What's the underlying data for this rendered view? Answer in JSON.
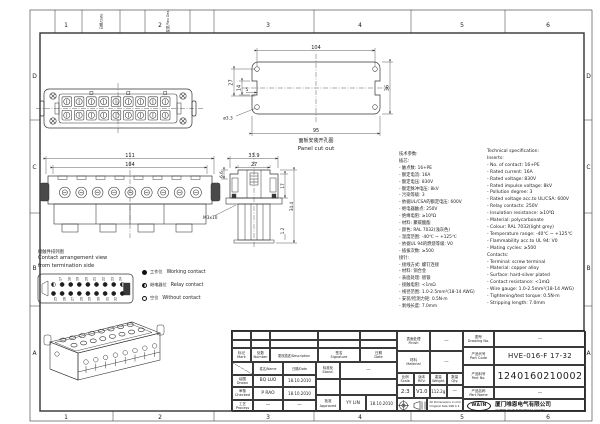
{
  "sheet": {
    "frame_columns": [
      "1",
      "2",
      "3",
      "4",
      "5",
      "6"
    ],
    "frame_rows": [
      "D",
      "C",
      "B",
      "A"
    ],
    "corner_cells": {
      "date": "日期/Date",
      "rev": "变更/Rev Des"
    }
  },
  "views": {
    "panel_cutout": {
      "caption_cn": "面板安装开孔图",
      "caption_en": "Panel cut out",
      "dim_hole_spacing": "104",
      "dim_inner_width": "95",
      "dim_height": "36",
      "dim_left_outer": "27",
      "dim_left_inner": "14",
      "dim_notch": "5",
      "dim_hole_dia": "ø3.3"
    },
    "side_view": {
      "dim_overall_width": "111",
      "dim_inner_width": "104"
    },
    "end_view": {
      "dim_width": "33.9",
      "dim_inner_width": "27",
      "dim_flange": "6.6",
      "dim_upper_height": "17",
      "dim_total_height": "34.4",
      "dim_foot": "1.2",
      "screw_label": "M3x10"
    },
    "arrangement": {
      "caption_cn": "接触件排列图",
      "caption_en_line1": "Contact arrangement view",
      "caption_en_line2": "from termination side",
      "top_numbers": [
        "17",
        "18",
        "19",
        "20",
        "21",
        "22",
        "23",
        "24"
      ],
      "bottom_numbers": [
        "25",
        "26",
        "27",
        "28",
        "29",
        "30",
        "31",
        "32"
      ],
      "legend": [
        {
          "cn": "工作位",
          "en": "Working contact"
        },
        {
          "cn": "继电器位",
          "en": "Relay contact"
        },
        {
          "cn": "空位",
          "en": "Without contact"
        }
      ]
    }
  },
  "specs_cn": {
    "title": "技术参数:",
    "inserts_heading": "插芯:",
    "inserts": [
      "- 触点数: 16+PE",
      "- 额定电流: 16A",
      "- 额定电压: 830V",
      "- 额定脉冲电压: 8kV",
      "- 污染等级: 3",
      "- 依据UL/CSA的额定电压: 600V",
      "- 继电器触点: 250V",
      "- 绝缘电阻: ≥10⁸Ω",
      "- 材料: 聚碳酸酯",
      "- 颜色: RAL 7032(浅灰色)",
      "- 温度范围: -40℃ ~ +125℃",
      "- 依据UL 94的燃烧等级: V0",
      "- 插拔次数: ≥500"
    ],
    "contacts_heading": "接针:",
    "contacts": [
      "- 接线方式: 螺钉连接",
      "- 材料: 铜合金",
      "- 表面处理: 镀银",
      "- 接触电阻: <1mΩ",
      "- 线径范围: 1.0-2.5mm²(18-14 AWG)",
      "- 安装/检测力矩: 0.5N·m",
      "- 剥线长度: 7.0mm"
    ]
  },
  "specs_en": {
    "title": "Technical specification:",
    "inserts_heading": "Inserts:",
    "inserts": [
      "- No. of contact: 16+PE",
      "- Rated current: 16A",
      "- Rated voltage: 830V",
      "- Rated impulse voltage: 8kV",
      "- Pollution degree: 3",
      "- Rated voltage acc.to UL/CSA: 600V",
      "- Relay contacts: 250V",
      "- Insulation resistance: ≥10⁸Ω",
      "- Material: polycarbonate",
      "- Colour: RAL 7032(light grey)",
      "- Temperature range: -40℃ ~ +125℃",
      "- Flammability acc.to UL 94: V0",
      "- Mating cycles: ≥500"
    ],
    "contacts_heading": "Contacts:",
    "contacts": [
      "- Terminal: screw terminal",
      "- Material: copper alloy",
      "- Surface: hard-silver plated",
      "- Contact resistance: <1mΩ",
      "- Wire gauge: 1.0-2.5mm²(18-14 AWG)",
      "- Tightening/test torque: 0.5N·m",
      "- Stripping length: 7.0mm"
    ]
  },
  "title_block": {
    "rev_header": {
      "mark": "标记\nMark",
      "number": "处数\nNumber",
      "description": "更改描述/Description",
      "signature": "签名\nSignature",
      "date": "日期\nDate"
    },
    "name_header": "姓名/Name",
    "date_header": "日期/Date",
    "drawn": {
      "label": "绘图\nDrawn",
      "name": "BQ LUO",
      "date": "18.10.2010"
    },
    "checked": {
      "label": "审核\nChecked",
      "name": "P RAO",
      "date": "18.10.2010"
    },
    "process": {
      "label": "工艺\nProcess",
      "name": "—",
      "date": "—"
    },
    "standard": {
      "label": "标准化\nStand.",
      "value": "—"
    },
    "approved": {
      "label": "批准\nApproved",
      "name": "YY LIN",
      "date": "18.10.2010"
    },
    "finish": {
      "label": "表面处理\nFinish",
      "value": "—"
    },
    "material": {
      "label": "材料\nMaterial",
      "value": "—"
    },
    "scale": {
      "label": "比例\nScale",
      "value": "2:3"
    },
    "rev": {
      "label": "版本\nREV.",
      "value": "V1.0"
    },
    "weight": {
      "label": "重量\nWeight",
      "value": "112.2g"
    },
    "qty": {
      "label": "数量\nQty.",
      "value": "—"
    },
    "dim_note": "All Dimensions in mm\nOriginal Size DIN A 4",
    "drawing_no": {
      "label": "图号\nDrawing No.",
      "value": "—"
    },
    "part_code": {
      "label": "产品代号\nPart Code",
      "value": "HVE-016-F 17-32"
    },
    "part_no": {
      "label": "产品料号\nPart No.",
      "value": "1240160210002"
    },
    "part_name": {
      "label": "产品名称\nPart Name",
      "value": "—"
    },
    "company": {
      "logo": "WAIN",
      "cn": "厦门唯恩电气有限公司",
      "en": "XIAMEN WAIN ELECTRICAL CO.LTD"
    }
  }
}
